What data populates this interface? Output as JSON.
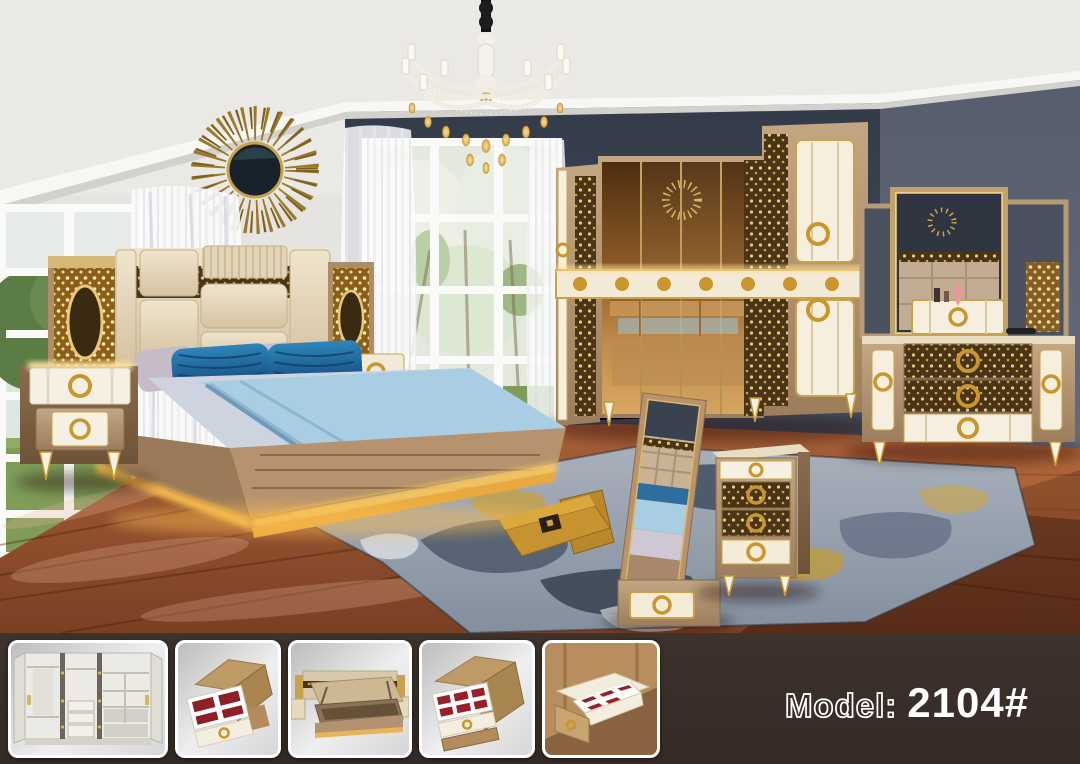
{
  "caption": {
    "label": "Model:",
    "value": "2104#",
    "full_text": "Model: 2104#"
  },
  "thumbnails": [
    {
      "name": "wardrobe-interior-view"
    },
    {
      "name": "nightstand-open-drawer-view"
    },
    {
      "name": "bed-lift-up-storage-view"
    },
    {
      "name": "chest-open-drawer-view"
    },
    {
      "name": "drawer-compartments-top-view"
    }
  ],
  "colors": {
    "strip_background": "#372c26",
    "caption_text": "#ffffff",
    "gold_accent": "#c9a24a",
    "accent_wall": "#3f4856",
    "right_wall": "#5d6473",
    "floor_wood": "#96532f",
    "rug_base": "#97a0ac",
    "pillow_blue": "#1c6396",
    "upholstery_cream": "#e4d7bd",
    "mirror_bronze": "#8a5a26"
  }
}
